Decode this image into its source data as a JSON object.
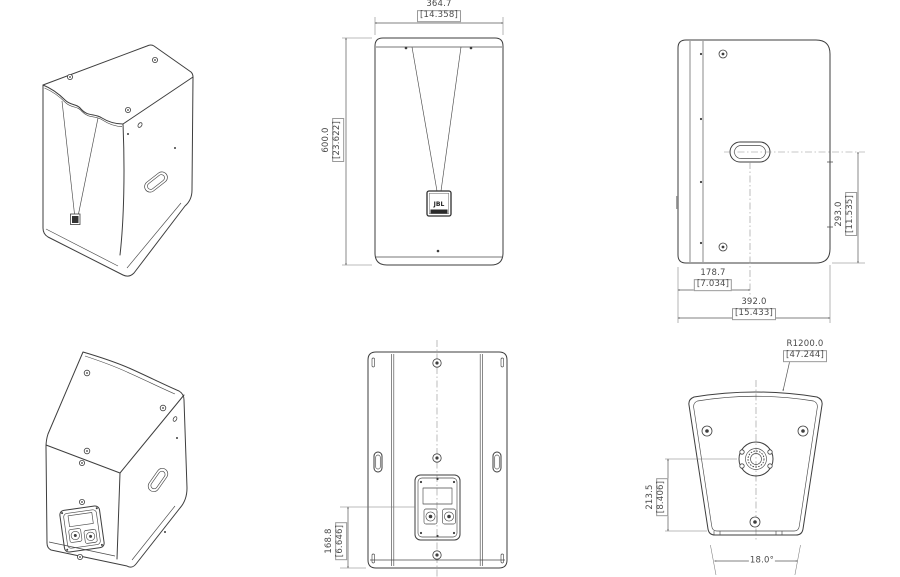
{
  "page": {
    "background": "#ffffff",
    "line_color": "#3e3e3e",
    "dim_color": "#4a4a4a"
  },
  "views": {
    "front": {
      "logo_text": "JBL",
      "width_dim": {
        "mm": "364.7",
        "inch": "[14.358]"
      },
      "height_dim": {
        "mm": "600.0",
        "inch": "[23.622]"
      }
    },
    "side": {
      "handle_height_dim": {
        "mm": "293.0",
        "inch": "[11.535]"
      },
      "handle_setback_dim": {
        "mm": "178.7",
        "inch": "[7.034]"
      },
      "depth_dim": {
        "mm": "392.0",
        "inch": "[15.433]"
      }
    },
    "rear": {
      "connector_height_dim": {
        "mm": "168.8",
        "inch": "[6.646]"
      }
    },
    "bottom": {
      "front_radius_dim": {
        "mm": "R1200.0",
        "inch": "[47.244]"
      },
      "socket_to_rear_dim": {
        "mm": "213.5",
        "inch": "[8.406]"
      },
      "wedge_angle_dim": "18.0°"
    }
  }
}
